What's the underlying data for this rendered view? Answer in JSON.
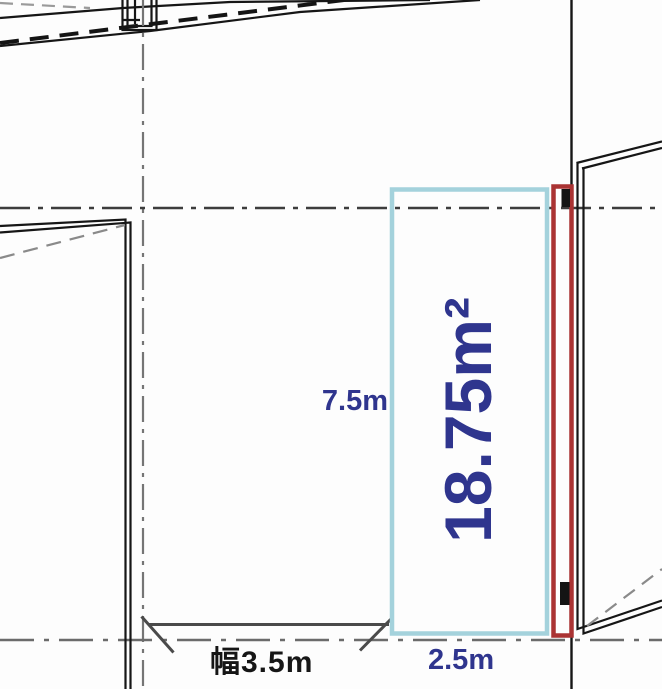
{
  "plan": {
    "area_label": "18.75m²",
    "depth_label": "7.5m",
    "width_label": "2.5m",
    "frontage_label": "幅3.5m"
  },
  "colors": {
    "highlight_box": "#a4d2dc",
    "accent_box": "#aa3333",
    "dimension_text": "#2f358e",
    "frontage_text": "#161616",
    "wall_line": "#161616",
    "centerline": "#6b6b6b"
  }
}
